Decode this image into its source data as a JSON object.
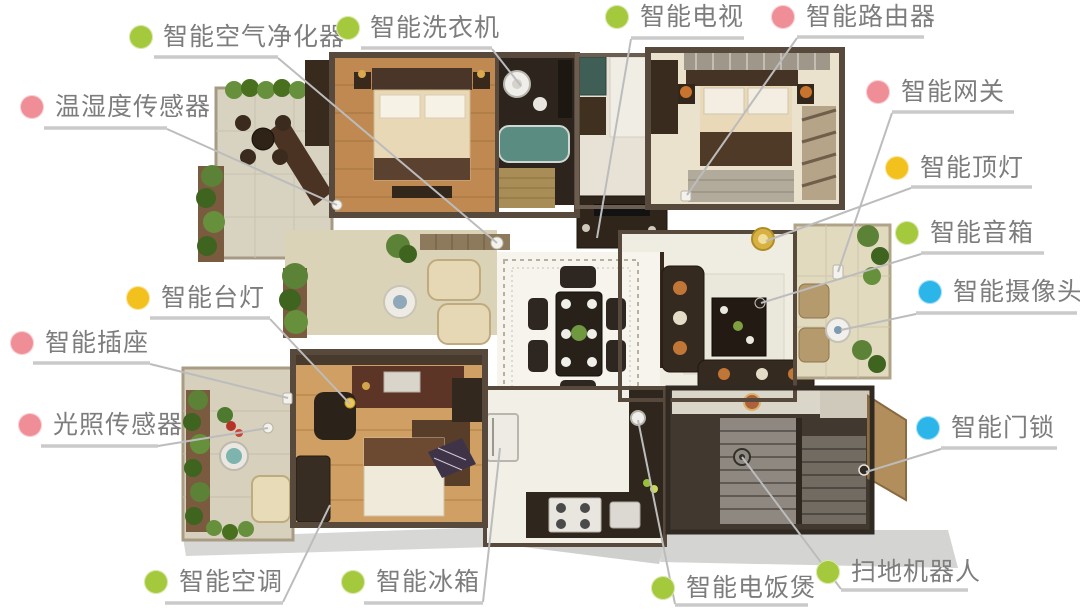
{
  "palette": {
    "dot_green": "#a4c93c",
    "dot_pink": "#ef8e96",
    "dot_yellow": "#f2c11e",
    "dot_blue": "#2cb5e8",
    "label_text": "#7d7d7d",
    "underline": "#cacaca",
    "leader_line": "#bcbcbc",
    "background": "#ffffff"
  },
  "labels": [
    {
      "id": "air-purifier",
      "text": "智能空气净化器",
      "color": "#a4c93c",
      "dot": {
        "x": 141,
        "y": 37
      },
      "text_pos": {
        "x": 163,
        "y": 22
      },
      "underline": {
        "x1": 154,
        "x2": 278,
        "y": 57
      },
      "leader": {
        "x1": 278,
        "y1": 58,
        "x2": 497,
        "y2": 243
      }
    },
    {
      "id": "washing-machine",
      "text": "智能洗衣机",
      "color": "#a4c93c",
      "dot": {
        "x": 348,
        "y": 28
      },
      "text_pos": {
        "x": 370,
        "y": 13
      },
      "underline": {
        "x1": 361,
        "x2": 492,
        "y": 48
      },
      "leader": {
        "x1": 492,
        "y1": 49,
        "x2": 521,
        "y2": 86
      }
    },
    {
      "id": "tv",
      "text": "智能电视",
      "color": "#a4c93c",
      "dot": {
        "x": 617,
        "y": 17
      },
      "text_pos": {
        "x": 640,
        "y": 2
      },
      "underline": {
        "x1": 631,
        "x2": 744,
        "y": 38
      },
      "leader": {
        "x1": 631,
        "y1": 39,
        "x2": 597,
        "y2": 238
      }
    },
    {
      "id": "router",
      "text": "智能路由器",
      "color": "#ef8e96",
      "dot": {
        "x": 783,
        "y": 17
      },
      "text_pos": {
        "x": 806,
        "y": 2
      },
      "underline": {
        "x1": 797,
        "x2": 924,
        "y": 37
      },
      "leader": {
        "x1": 797,
        "y1": 38,
        "x2": 687,
        "y2": 195
      }
    },
    {
      "id": "gateway",
      "text": "智能网关",
      "color": "#ef8e96",
      "dot": {
        "x": 878,
        "y": 92
      },
      "text_pos": {
        "x": 901,
        "y": 77
      },
      "underline": {
        "x1": 892,
        "x2": 1014,
        "y": 112
      },
      "leader": {
        "x1": 892,
        "y1": 113,
        "x2": 838,
        "y2": 272
      }
    },
    {
      "id": "ceiling-light",
      "text": "智能顶灯",
      "color": "#f2c11e",
      "dot": {
        "x": 897,
        "y": 168
      },
      "text_pos": {
        "x": 920,
        "y": 153
      },
      "underline": {
        "x1": 911,
        "x2": 1032,
        "y": 187
      },
      "leader": {
        "x1": 911,
        "y1": 188,
        "x2": 766,
        "y2": 241
      }
    },
    {
      "id": "speaker",
      "text": "智能音箱",
      "color": "#a4c93c",
      "dot": {
        "x": 907,
        "y": 233
      },
      "text_pos": {
        "x": 930,
        "y": 218
      },
      "underline": {
        "x1": 921,
        "x2": 1044,
        "y": 253
      },
      "leader": {
        "x1": 921,
        "y1": 254,
        "x2": 761,
        "y2": 303
      }
    },
    {
      "id": "camera",
      "text": "智能摄像头",
      "color": "#2cb5e8",
      "dot": {
        "x": 930,
        "y": 292
      },
      "text_pos": {
        "x": 953,
        "y": 277
      },
      "underline": {
        "x1": 916,
        "x2": 1077,
        "y": 313
      },
      "leader": {
        "x1": 916,
        "y1": 314,
        "x2": 841,
        "y2": 330
      }
    },
    {
      "id": "door-lock",
      "text": "智能门锁",
      "color": "#2cb5e8",
      "dot": {
        "x": 928,
        "y": 428
      },
      "text_pos": {
        "x": 951,
        "y": 413
      },
      "underline": {
        "x1": 941,
        "x2": 1057,
        "y": 448
      },
      "leader": {
        "x1": 941,
        "y1": 449,
        "x2": 866,
        "y2": 472
      }
    },
    {
      "id": "temp-humidity-sensor",
      "text": "温湿度传感器",
      "color": "#ef8e96",
      "dot": {
        "x": 32,
        "y": 107
      },
      "text_pos": {
        "x": 55,
        "y": 92
      },
      "underline": {
        "x1": 44,
        "x2": 167,
        "y": 128
      },
      "leader": {
        "x1": 167,
        "y1": 129,
        "x2": 337,
        "y2": 205
      }
    },
    {
      "id": "desk-lamp",
      "text": "智能台灯",
      "color": "#f2c11e",
      "dot": {
        "x": 138,
        "y": 298
      },
      "text_pos": {
        "x": 161,
        "y": 283
      },
      "underline": {
        "x1": 150,
        "x2": 270,
        "y": 318
      },
      "leader": {
        "x1": 270,
        "y1": 319,
        "x2": 350,
        "y2": 404
      }
    },
    {
      "id": "socket",
      "text": "智能插座",
      "color": "#ef8e96",
      "dot": {
        "x": 22,
        "y": 343
      },
      "text_pos": {
        "x": 45,
        "y": 328
      },
      "underline": {
        "x1": 33,
        "x2": 150,
        "y": 363
      },
      "leader": {
        "x1": 150,
        "y1": 364,
        "x2": 288,
        "y2": 398
      }
    },
    {
      "id": "light-sensor",
      "text": "光照传感器",
      "color": "#ef8e96",
      "dot": {
        "x": 30,
        "y": 425
      },
      "text_pos": {
        "x": 53,
        "y": 410
      },
      "underline": {
        "x1": 41,
        "x2": 158,
        "y": 446
      },
      "leader": {
        "x1": 158,
        "y1": 446,
        "x2": 268,
        "y2": 428
      }
    },
    {
      "id": "ac",
      "text": "智能空调",
      "color": "#a4c93c",
      "dot": {
        "x": 156,
        "y": 582
      },
      "text_pos": {
        "x": 179,
        "y": 567
      },
      "underline": {
        "x1": 165,
        "x2": 283,
        "y": 603
      },
      "leader": {
        "x1": 283,
        "y1": 602,
        "x2": 330,
        "y2": 505
      }
    },
    {
      "id": "fridge",
      "text": "智能冰箱",
      "color": "#a4c93c",
      "dot": {
        "x": 353,
        "y": 582
      },
      "text_pos": {
        "x": 376,
        "y": 567
      },
      "underline": {
        "x1": 364,
        "x2": 483,
        "y": 603
      },
      "leader": {
        "x1": 483,
        "y1": 602,
        "x2": 500,
        "y2": 448
      }
    },
    {
      "id": "rice-cooker",
      "text": "智能电饭煲",
      "color": "#a4c93c",
      "dot": {
        "x": 663,
        "y": 588
      },
      "text_pos": {
        "x": 686,
        "y": 573
      },
      "underline": {
        "x1": 675,
        "x2": 808,
        "y": 605
      },
      "leader": {
        "x1": 675,
        "y1": 604,
        "x2": 638,
        "y2": 420
      }
    },
    {
      "id": "sweeping-robot",
      "text": "扫地机器人",
      "color": "#a4c93c",
      "dot": {
        "x": 828,
        "y": 572
      },
      "text_pos": {
        "x": 851,
        "y": 557
      },
      "underline": {
        "x1": 841,
        "x2": 968,
        "y": 590
      },
      "leader": {
        "x1": 841,
        "y1": 589,
        "x2": 742,
        "y2": 457
      }
    }
  ]
}
